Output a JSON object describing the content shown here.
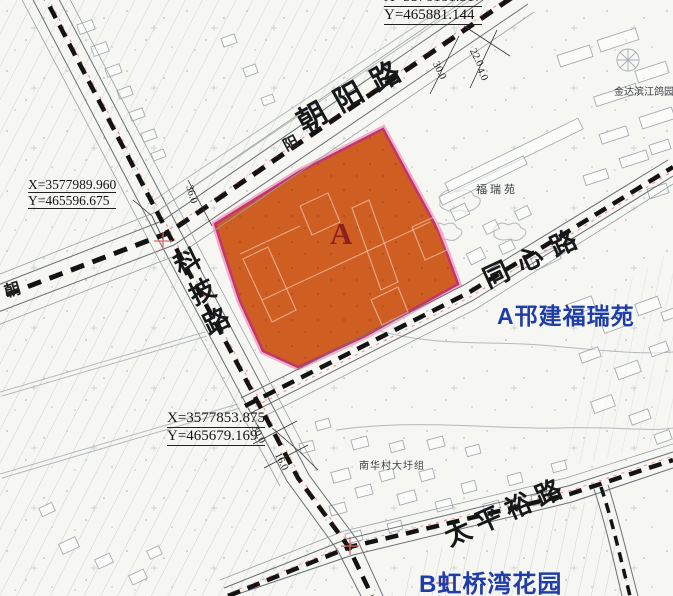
{
  "map_labels": {
    "road_chaoyang": "朝阳路",
    "road_chaoyang_char_small": "阳",
    "road_chaoyang_char_left": "朝",
    "road_keji": "科技路",
    "road_tongxin": "同心路",
    "road_taipingyu": "太平裕路"
  },
  "site": {
    "parcel_letter": "A"
  },
  "legend": {
    "site_a": "A邗建福瑞苑",
    "site_b": "B虹桥湾花园"
  },
  "places": {
    "furuiyuan": "福瑞苑",
    "jinda_binjiang": "金达滨江鸽园",
    "nanhua_village": "南华村大圩组"
  },
  "coordinates": {
    "top": {
      "x": "X=3578181.517",
      "y": "Y=465881.144"
    },
    "left": {
      "x": "X=3577989.960",
      "y": "Y=465596.675"
    },
    "bottom": {
      "x": "X=3577853.875",
      "y": "Y=465679.169"
    }
  },
  "dims": {
    "d36": "36.0",
    "d30_top": "30.0",
    "d22": "22.0",
    "d4": "4.0",
    "d30_bottom": "30.0",
    "d16": "16.0"
  },
  "colors": {
    "parcel_fill": "#cf5e22",
    "parcel_border": "#c2366b",
    "parcel_border_halo": "#ef9ec2",
    "legend_blue": "#1f3da8",
    "road_dash": "#131313",
    "red_line": "#d96a6a"
  }
}
